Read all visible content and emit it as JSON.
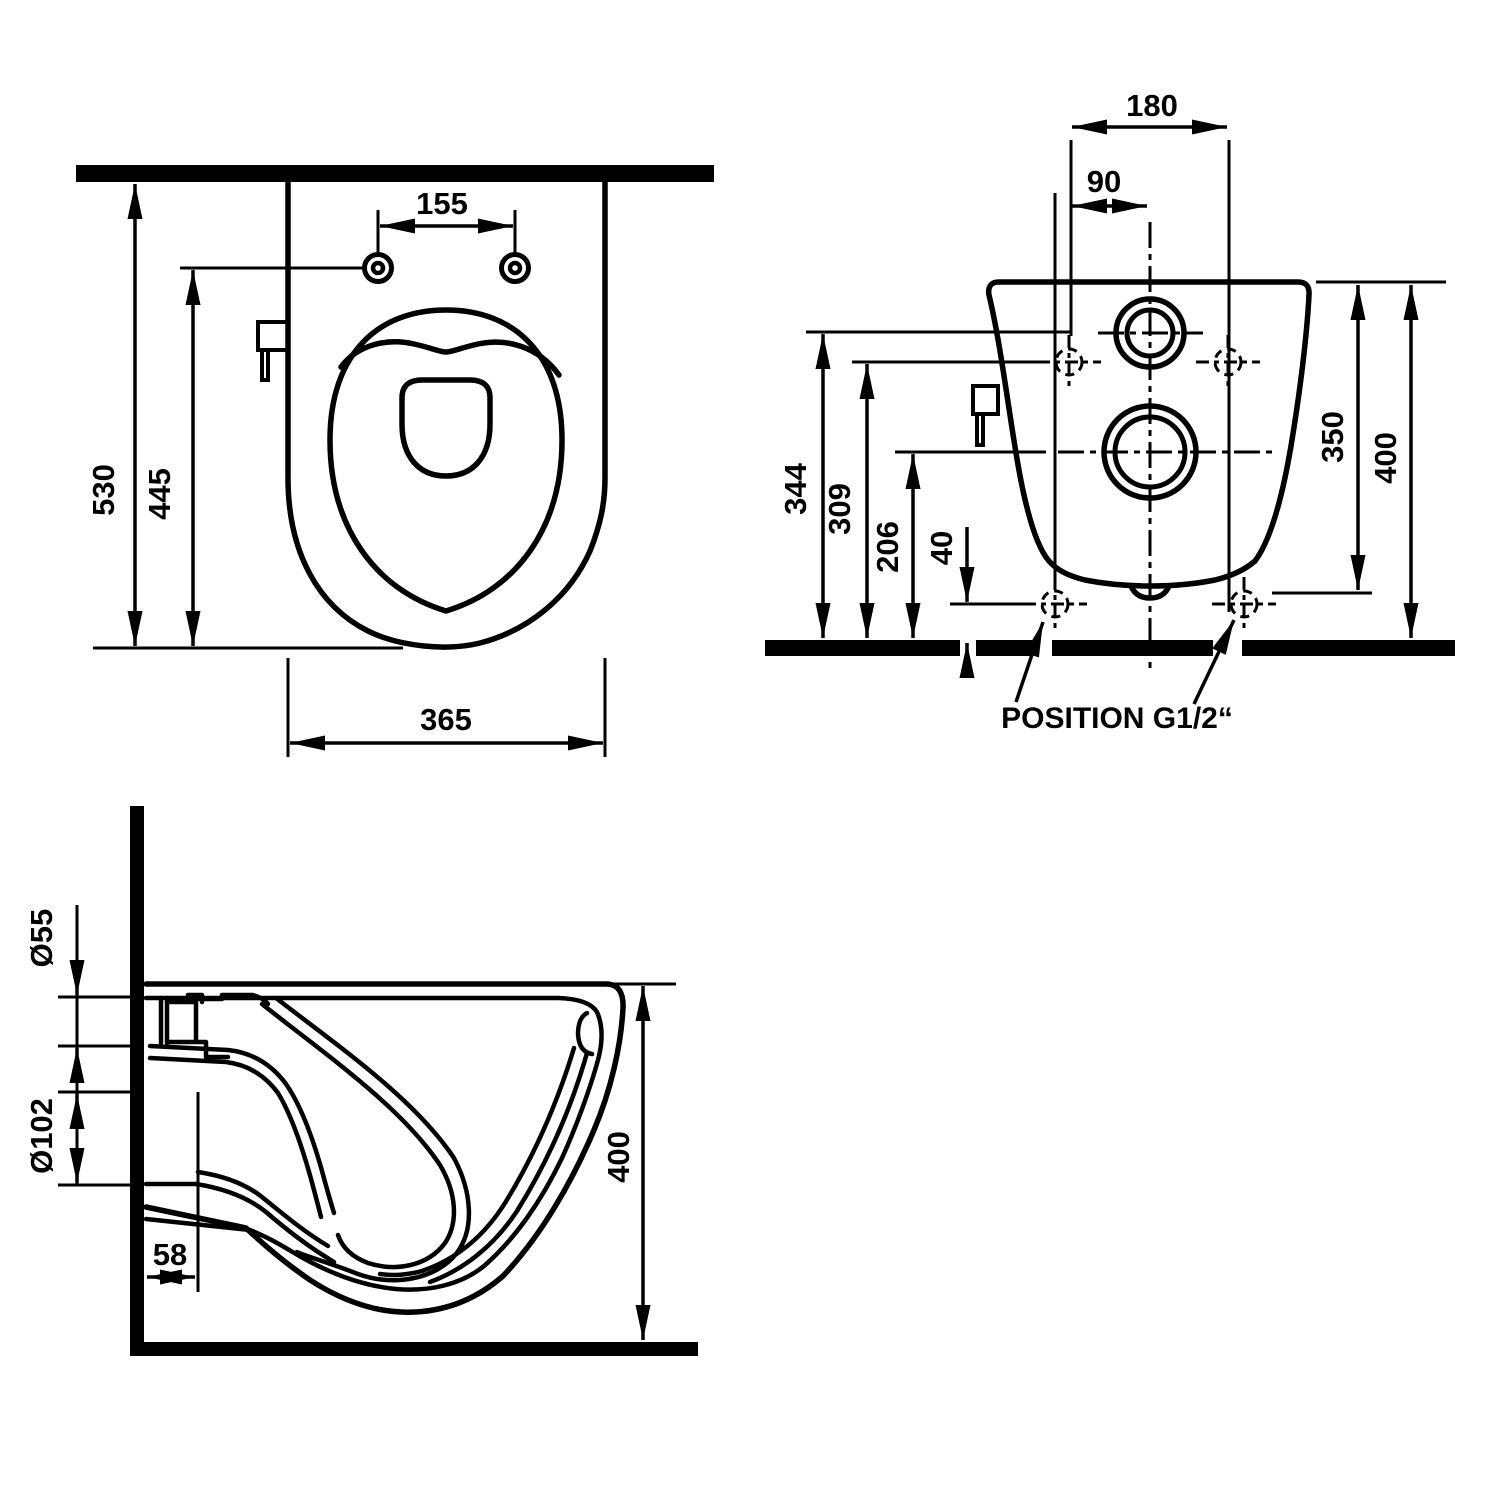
{
  "drawing": {
    "type": "technical-dimension-drawing",
    "subject": "wall-hung toilet with bidet sprayer",
    "ink_color": "#000000",
    "background_color": "#ffffff"
  },
  "views": {
    "top_view": {
      "title": "top view",
      "dims": {
        "depth_overall": "530",
        "depth_to_holes": "445",
        "hole_spacing": "155",
        "body_width": "365"
      }
    },
    "rear_view": {
      "title": "rear view",
      "dims": {
        "upper_hole_spacing": "180",
        "hole_to_center": "90",
        "inlet_height": "344",
        "upper_holes_height": "309",
        "outlet_height": "206",
        "connection_height": "40",
        "rim_to_connection": "350",
        "overall_height": "400"
      },
      "annotation": "POSITION G1/2“"
    },
    "side_view": {
      "title": "side section view",
      "dims": {
        "inlet_diameter": "Ø55",
        "outlet_diameter": "Ø102",
        "spud_length": "58",
        "overall_height": "400"
      }
    }
  }
}
